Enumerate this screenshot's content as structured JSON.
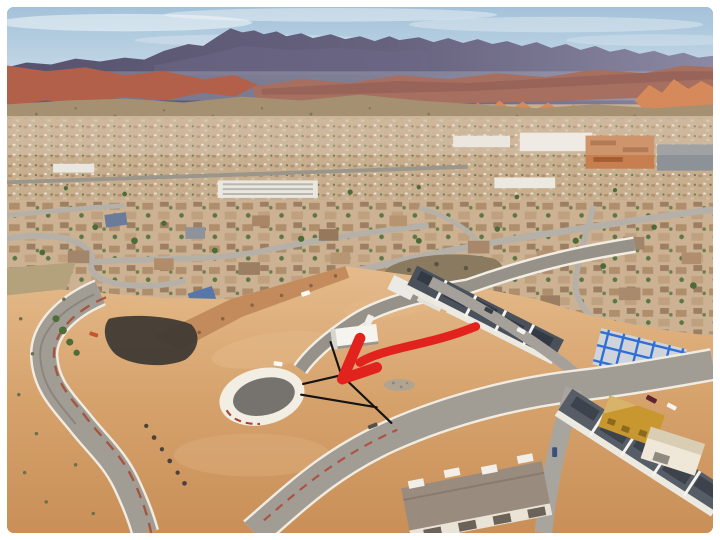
{
  "frame": {
    "border_color": "#ffffff"
  },
  "scene": {
    "description": "Aerial drone photograph of a desert town beneath a blue-gray mountain range and red-rock cliffs; foreground shows a graded dirt lot with a new cul-de-sac street, townhomes under construction, and winding roads.",
    "sky": {
      "top": "#a3c2da",
      "bottom": "#d4e1ea",
      "cloud": "#f3f7f9"
    },
    "mountains": {
      "dark": "#57536e",
      "light": "#8b88a3"
    },
    "red_rock": {
      "left_mesa": "#b2604a",
      "band": "#a76f60",
      "orange": "#d6895a"
    },
    "hills_olive": "#a59072",
    "town_base": "#c7ae8f",
    "residential_base": "#ccb293",
    "dirt": {
      "base": "#d6a26c",
      "light": "#e5bb8b",
      "deep": "#c98f58"
    },
    "roads": {
      "old": "#a19d94",
      "new": "#96928a",
      "asphalt_dark": "#76736f",
      "curb": "#f2eee4",
      "red_curb": "#a6492f"
    },
    "burned_patch": "#403a34",
    "construction": {
      "roof_dark": "#4a515b",
      "roof_row2": "#565d66",
      "walls": "#ece9e1",
      "blue_frame": "#2f6fd6",
      "yellow_building": "#c9972f",
      "taupe_roof": "#998b7d",
      "trailer_white": "#f5f4ef"
    }
  },
  "annotation": {
    "arrow": {
      "color": "#e2231d",
      "shaft_path": "M 478 328 C 444 342 411 347 387 354 C 373 358 366 361 360 365",
      "head_path": "M 360 340 L 342 382 L 377 370",
      "shaft_width": 9,
      "head_width": 11
    },
    "lot_lines": {
      "color": "#141414",
      "path": "M 330 344 L 341 378 L 302 387 M 341 378 L 392 427 M 300 398 L 377 411",
      "width": 2.2
    }
  }
}
